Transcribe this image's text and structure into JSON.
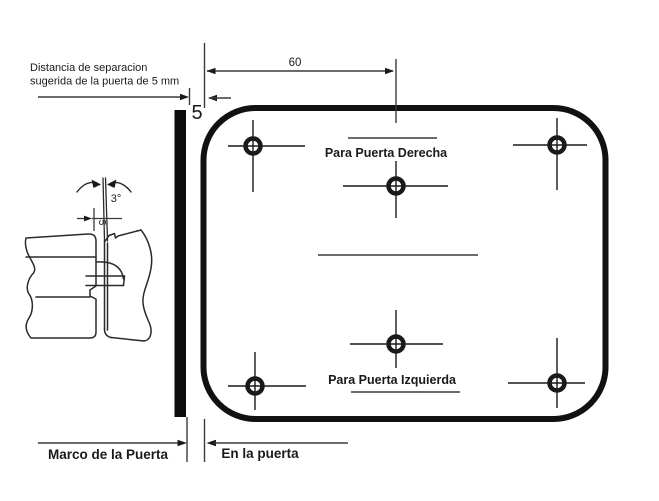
{
  "diagram": {
    "title_hint": "door roller catch installation drawing",
    "annotations": {
      "gap_note_line1": "Distancia de separacion",
      "gap_note_line2": "sugerida de la puerta de 5 mm",
      "gap_value": "5",
      "top_width_value": "60",
      "angle_value": "3°",
      "detail_gap_value": "5",
      "right_door_label": "Para Puerta Derecha",
      "left_door_label": "Para Puerta Izquierda",
      "door_frame_label": "Marco de la Puerta",
      "on_door_label": "En la puerta"
    },
    "colors": {
      "ink": "#1a1a1a",
      "background": "#ffffff"
    }
  }
}
